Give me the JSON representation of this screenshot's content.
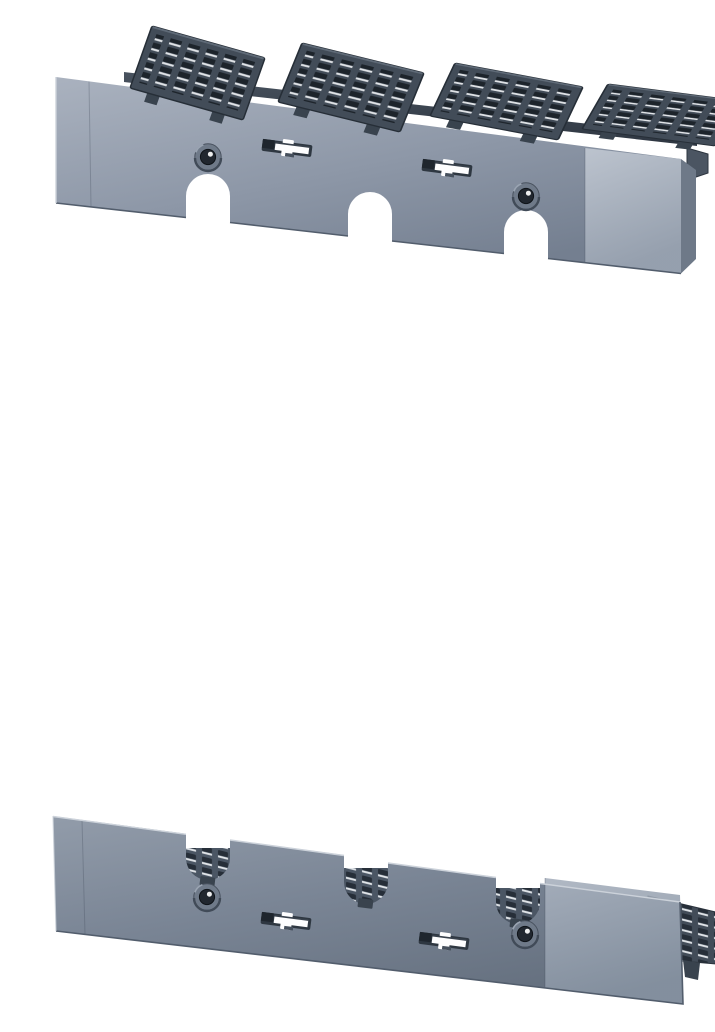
{
  "scene": {
    "background": "#ffffff",
    "description": "Product render on a white background of two slate-blue molded terminal covers for a 3-pole molded-case circuit breaker: the upper cover is shown from above with four ventilated grille flaps hinged open along its top edge; the lower cover is shown from below with three U-shaped cable notches backed by ventilation grilles and a side vent flap on the right.",
    "parts": [
      {
        "id": "top-cover",
        "label": "Terminal cover with four vent flaps open",
        "vent_flaps": 4,
        "cable_notches": 3,
        "screw_holes": 2,
        "mounting_slots": 2
      },
      {
        "id": "bottom-cover",
        "label": "Terminal cover seen from below, grilles behind notches",
        "cable_notches": 3,
        "screw_holes": 2,
        "mounting_slots": 2,
        "side_vent_flaps": 1
      }
    ]
  },
  "colors": {
    "background": "#ffffff",
    "top_face_light": "#aab2bf",
    "top_face_mid": "#8d97a7",
    "top_face_dark": "#747f90",
    "top_end_light": "#c2c9d3",
    "top_end_dark": "#99a3b1",
    "bot_face_light": "#929caa",
    "bot_face_mid": "#7a8595",
    "bot_face_dark": "#667180",
    "bot_end_light": "#a8b1be",
    "bot_end_dark": "#8692a1",
    "side_sliver": "#6e7988",
    "slate_base": "#424c58",
    "slate_dark": "#262e37",
    "slate_tab": "#39434e",
    "rail_light": "#49535f",
    "rail_dark": "#2e3641",
    "slot_dark": "#1d242b",
    "glint_white": "#f3f5f8",
    "perf_slot": "#262e38",
    "perf_glint": "#eef1f5",
    "panel_base": "#4b5664",
    "ring_fill": "#6f7a89",
    "ring_shadow": "#454f5c",
    "hole_dark": "#21272f",
    "cut_white": "#fdfdfe",
    "key_frame": "#2e3741",
    "key_block": "#1f262e",
    "edge_dark": "#525d6c",
    "edge_light": "#ccd2da"
  }
}
